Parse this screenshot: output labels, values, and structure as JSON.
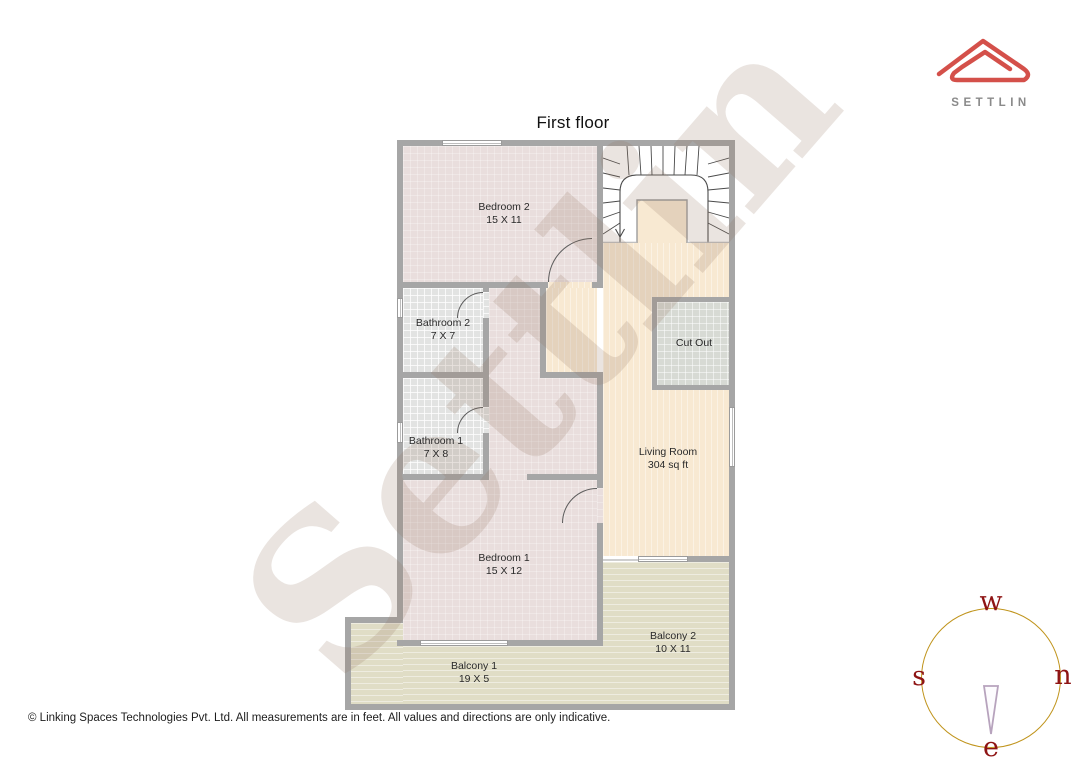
{
  "title": "First floor",
  "watermark": "Settlin",
  "brand": {
    "name": "SETTLIN"
  },
  "footer": {
    "copyright": "© Linking Spaces Technologies Pvt. Ltd. All measurements are in feet. All values and directions are only indicative."
  },
  "compass": {
    "top": "w",
    "left": "s",
    "right": "n",
    "bottom": "e"
  },
  "rooms": [
    {
      "name": "Bedroom 2",
      "dims": "15 X 11"
    },
    {
      "name": "Bathroom 2",
      "dims": "7 X 7"
    },
    {
      "name": "Bathroom 1",
      "dims": "7 X 8"
    },
    {
      "name": "Bedroom 1",
      "dims": "15 X 12"
    },
    {
      "name": "Living Room",
      "dims": "304 sq ft"
    },
    {
      "name": "Cut Out"
    },
    {
      "name": "Balcony 1",
      "dims": "19 X 5"
    },
    {
      "name": "Balcony 2",
      "dims": "10 X 11"
    }
  ],
  "palette": {
    "bedroom_floor": "#e9dedd",
    "bathroom_floor": "#e2e3e2",
    "living_floor": "#f8e9d2",
    "balcony_floor": "#e0ddc6",
    "cutout_floor": "#d7dad4",
    "wall": "#a6a6a6",
    "logo_red": "#d4504a",
    "logo_text": "#8a8a8a",
    "compass_circle": "#c0941c",
    "compass_letters": "#8e1414",
    "compass_needle": "#b7a3bd"
  }
}
